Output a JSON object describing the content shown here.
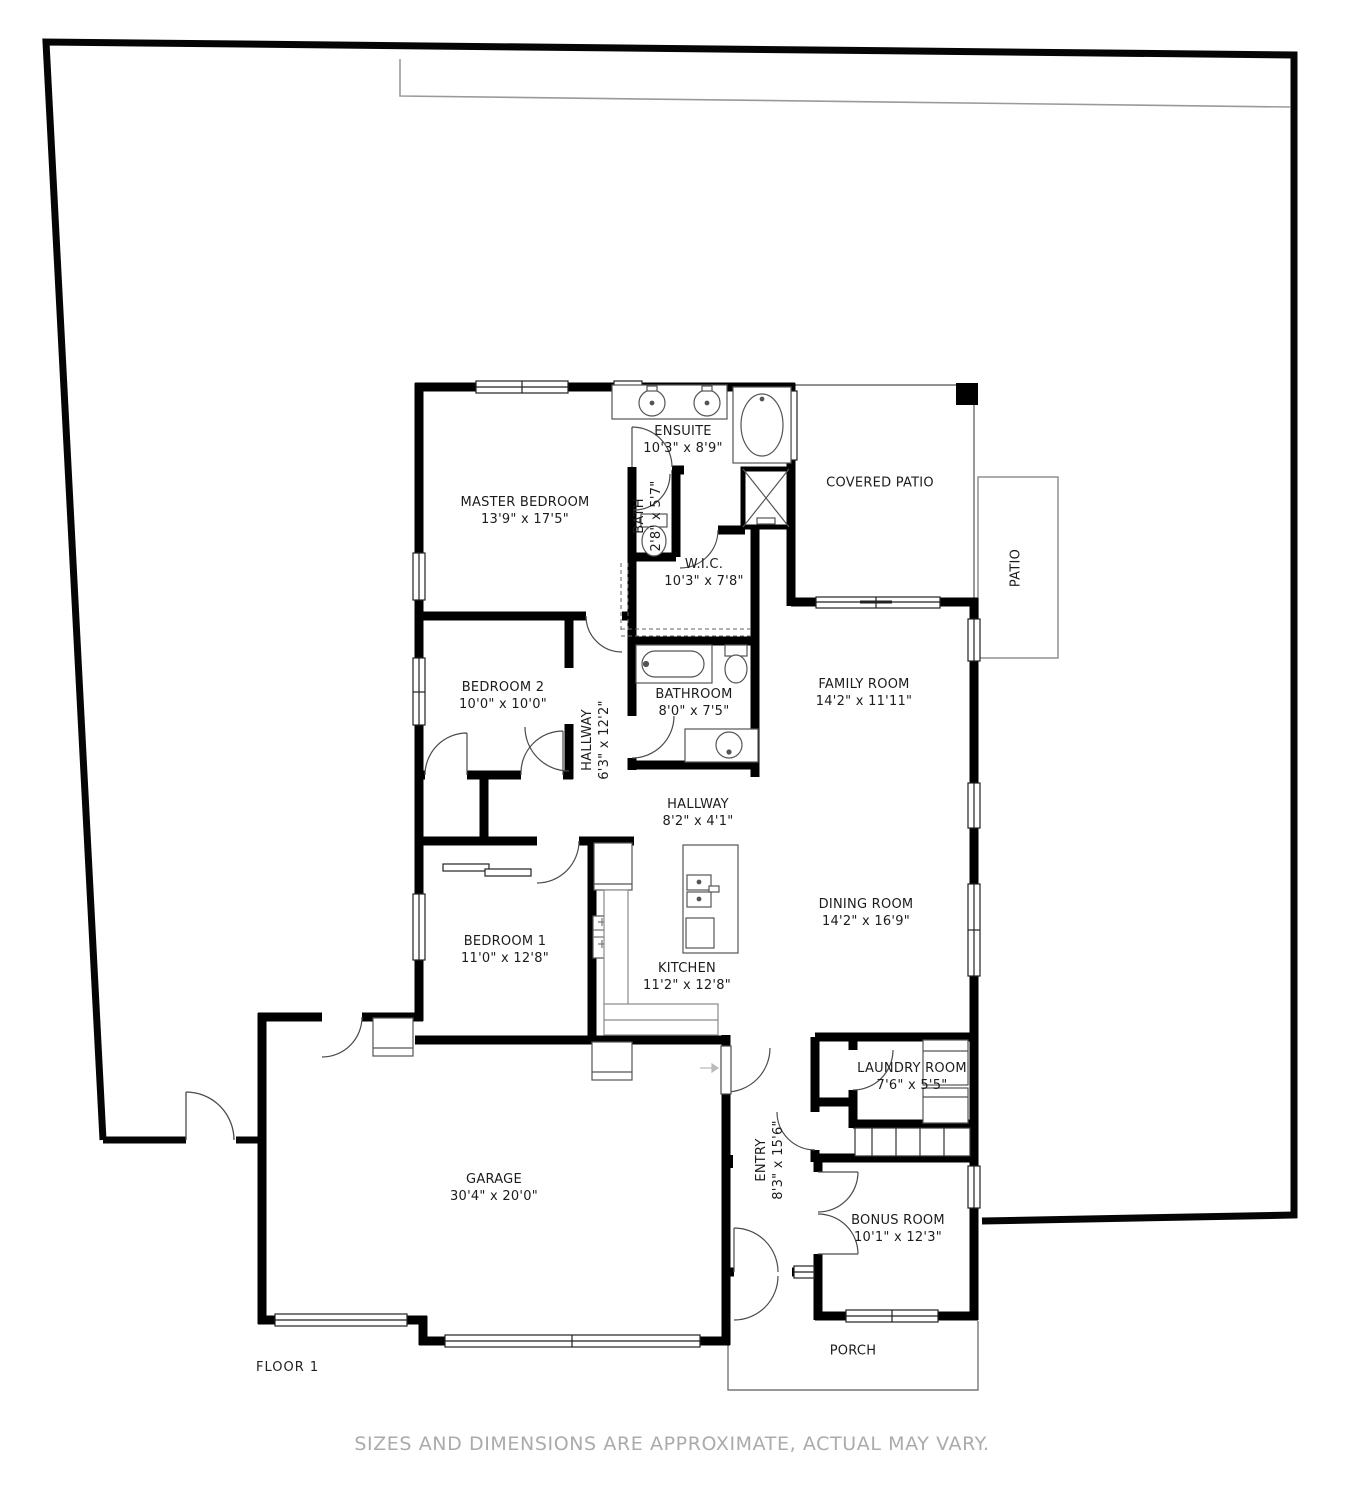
{
  "title": "Floor 1 floor plan",
  "floor_label": "FLOOR 1",
  "disclaimer": "SIZES AND DIMENSIONS ARE APPROXIMATE, ACTUAL MAY VARY.",
  "rooms": [
    {
      "id": "master-bedroom",
      "name": "MASTER BEDROOM",
      "dims": "13'9\" x 17'5\"",
      "x": 525,
      "y": 511,
      "rotated": false
    },
    {
      "id": "ensuite",
      "name": "ENSUITE",
      "dims": "10'3\" x 8'9\"",
      "x": 683,
      "y": 440,
      "rotated": false
    },
    {
      "id": "bath",
      "name": "BATH",
      "dims": "2'8\" x 5'7\"",
      "x": 648,
      "y": 516,
      "rotated": true
    },
    {
      "id": "wic",
      "name": "W.I.C.",
      "dims": "10'3\" x 7'8\"",
      "x": 704,
      "y": 573,
      "rotated": false
    },
    {
      "id": "covered-patio",
      "name": "COVERED PATIO",
      "dims": "",
      "x": 880,
      "y": 483,
      "rotated": false
    },
    {
      "id": "patio",
      "name": "PATIO",
      "dims": "",
      "x": 1016,
      "y": 568,
      "rotated": true
    },
    {
      "id": "bedroom-2",
      "name": "BEDROOM 2",
      "dims": "10'0\" x 10'0\"",
      "x": 503,
      "y": 696,
      "rotated": false
    },
    {
      "id": "hallway-1",
      "name": "HALLWAY",
      "dims": "6'3\" x 12'2\"",
      "x": 596,
      "y": 740,
      "rotated": true
    },
    {
      "id": "bathroom",
      "name": "BATHROOM",
      "dims": "8'0\" x 7'5\"",
      "x": 694,
      "y": 703,
      "rotated": false
    },
    {
      "id": "family-room",
      "name": "FAMILY ROOM",
      "dims": "14'2\" x 11'11\"",
      "x": 864,
      "y": 693,
      "rotated": false
    },
    {
      "id": "hallway-2",
      "name": "HALLWAY",
      "dims": "8'2\" x 4'1\"",
      "x": 698,
      "y": 813,
      "rotated": false
    },
    {
      "id": "dining-room",
      "name": "DINING ROOM",
      "dims": "14'2\" x 16'9\"",
      "x": 866,
      "y": 913,
      "rotated": false
    },
    {
      "id": "bedroom-1",
      "name": "BEDROOM 1",
      "dims": "11'0\" x 12'8\"",
      "x": 505,
      "y": 950,
      "rotated": false
    },
    {
      "id": "kitchen",
      "name": "KITCHEN",
      "dims": "11'2\" x 12'8\"",
      "x": 687,
      "y": 977,
      "rotated": false
    },
    {
      "id": "garage",
      "name": "GARAGE",
      "dims": "30'4\" x 20'0\"",
      "x": 494,
      "y": 1188,
      "rotated": false
    },
    {
      "id": "laundry-room",
      "name": "LAUNDRY ROOM",
      "dims": "7'6\" x 5'5\"",
      "x": 912,
      "y": 1077,
      "rotated": false
    },
    {
      "id": "entry",
      "name": "ENTRY",
      "dims": "8'3\" x 15'6\"",
      "x": 770,
      "y": 1160,
      "rotated": true
    },
    {
      "id": "bonus-room",
      "name": "BONUS ROOM",
      "dims": "10'1\" x 12'3\"",
      "x": 898,
      "y": 1229,
      "rotated": false
    },
    {
      "id": "porch",
      "name": "PORCH",
      "dims": "",
      "x": 853,
      "y": 1351,
      "rotated": false
    }
  ],
  "colors": {
    "wall": "#000000",
    "thin_outline": "#4b4b4b",
    "fixture": "#555555",
    "outdoor_outline": "#888888",
    "fence": "#9a9a9a",
    "text": "#1c1c1c",
    "disclaimer_text": "#ababab"
  }
}
